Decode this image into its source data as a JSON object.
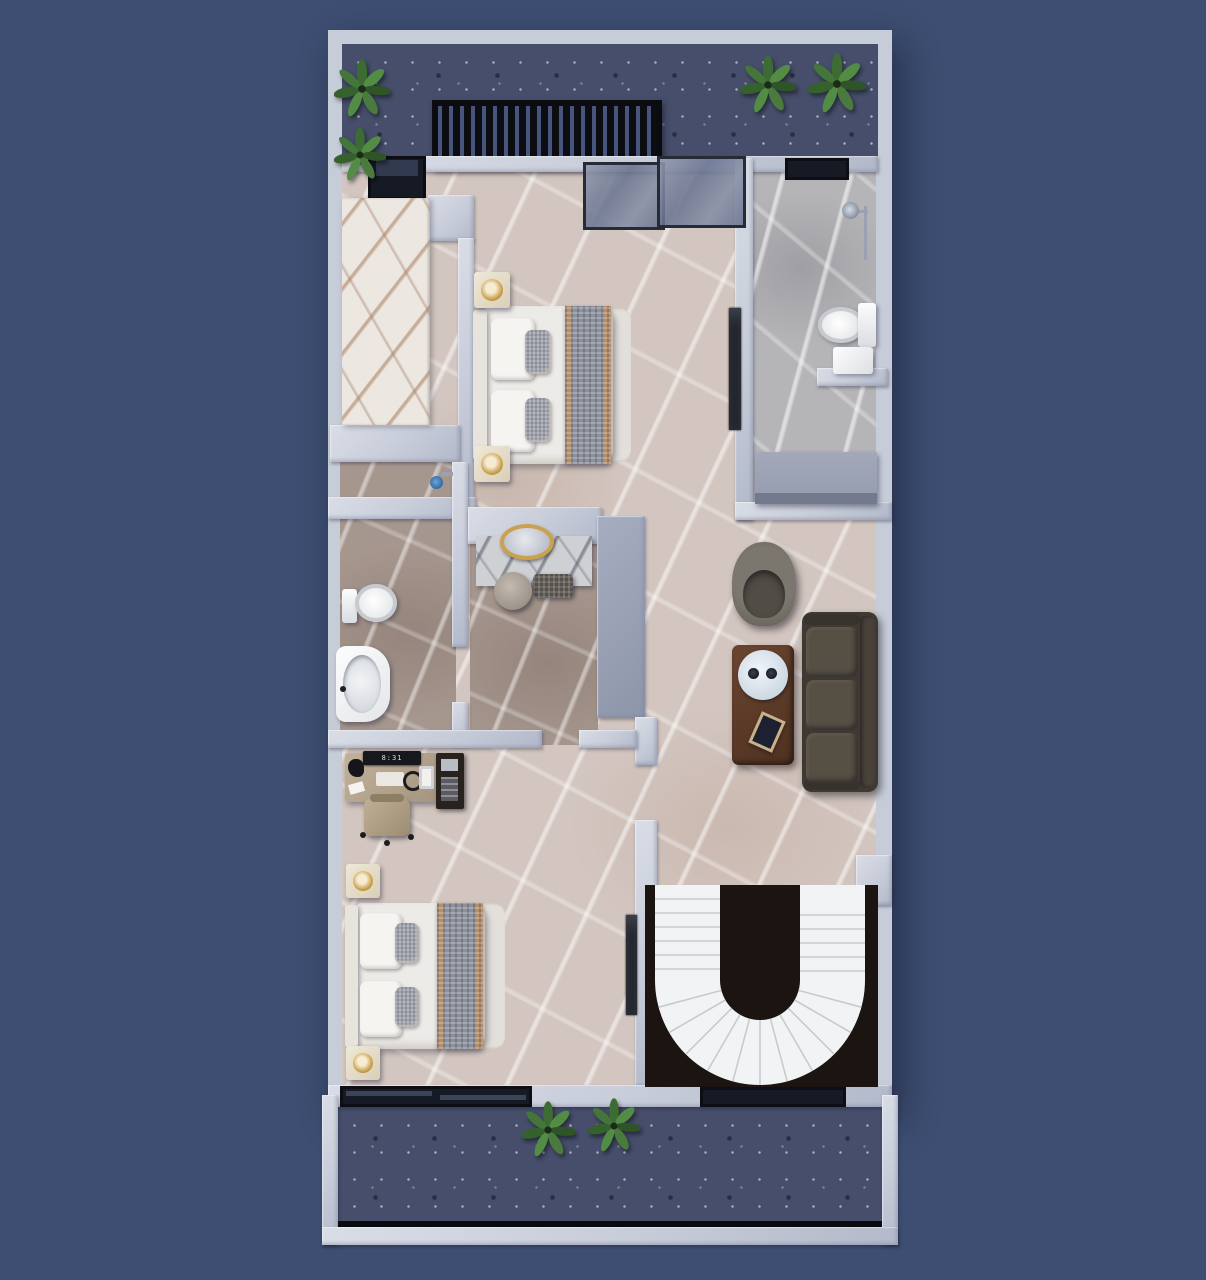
{
  "scene": {
    "type": "3d-architectural-floor-plan-top-view",
    "floor_shown": "upper floor with two bedrooms, two bathrooms, dressing area, living area, spiral staircase, front terrace and rear balcony",
    "clock_display": "8:31"
  },
  "palette": {
    "background": "#3d4e72",
    "wall": "#c7ccd9",
    "wall_shadow": "#8d95a9",
    "floor_beige_marble": "#d3c6c0",
    "floor_gray_marble": "#b5b4b7",
    "floor_brown_marble": "#a5968e",
    "terrace_floor": "#464e6b",
    "stair_void": "#1b1410",
    "stair_steps": "#f2f3f5",
    "sofa_brown": "#4a443c",
    "armchair_gray": "#6e6a63",
    "coffee_table_brown": "#5a3a29",
    "gold_accent": "#c9a14f",
    "plant_green": "#4a7a3d",
    "desk_tan": "#b7a893",
    "glass_frame": "#272b36",
    "marble_counter_vein": "#a77d5c"
  },
  "rooms": {
    "terrace_top": [
      "pergola-grille",
      "potted-plant x4",
      "dark speckled floor"
    ],
    "master_bedroom": [
      "double-bed",
      "nightstand x2",
      "gold-lamp x2",
      "glass-sliding-door"
    ],
    "walk_in_closet": [
      "white-marble-counter",
      "terrace-window"
    ],
    "ensuite_bathroom": [
      "shower-set",
      "wall-hung-toilet",
      "storage-box",
      "vanity-counter"
    ],
    "second_bathroom": [
      "toilet",
      "pedestal-sink",
      "shower-fixture"
    ],
    "dressing_area": [
      "marble-vanity-table",
      "round-gold-mirror",
      "bench",
      "stool",
      "wardrobe"
    ],
    "living_area": [
      "three-seat-sofa",
      "armchair",
      "coffee-table",
      "round-tray",
      "cups x2",
      "book"
    ],
    "bedroom_2": [
      "double-bed",
      "nightstand x2",
      "gold-lamp x2",
      "desk",
      "monitor-clock",
      "office-chair",
      "shelf-unit",
      "balcony-window"
    ],
    "stair_hall": [
      "spiral-staircase",
      "stair-void"
    ],
    "balcony_bottom": [
      "potted-plant x2",
      "railing",
      "dark speckled floor"
    ]
  }
}
